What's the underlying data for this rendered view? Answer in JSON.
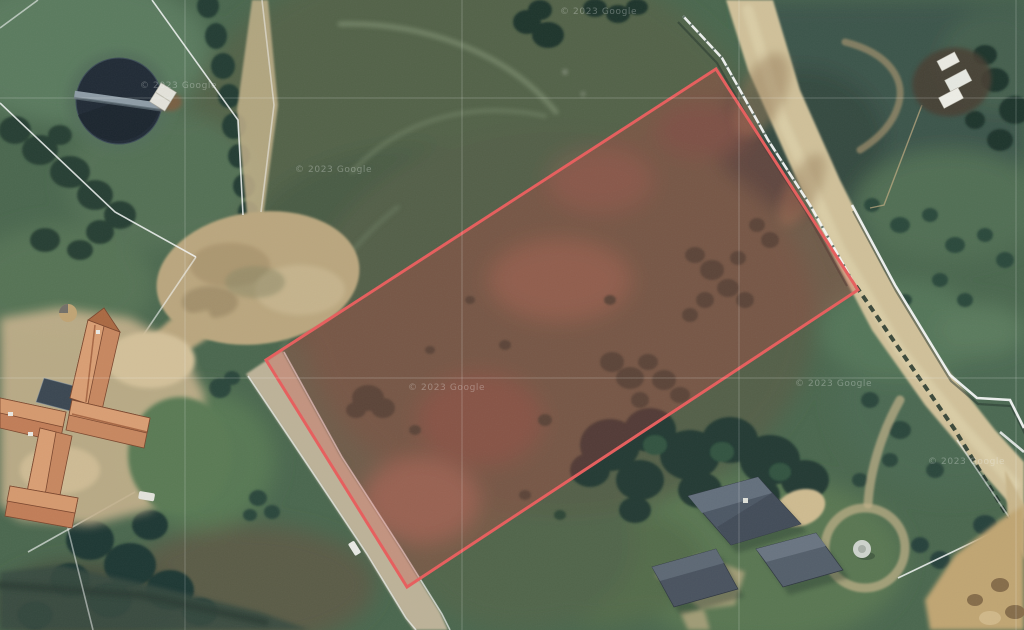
{
  "map": {
    "view_type": "satellite",
    "attribution": {
      "text": "© 2023 Google",
      "positions": [
        [
          560,
          14
        ],
        [
          295,
          172
        ],
        [
          140,
          88
        ],
        [
          408,
          390
        ],
        [
          795,
          386
        ],
        [
          928,
          464
        ]
      ]
    },
    "parcel_overlay": {
      "points": "716,69 858,290 407,587 266,360",
      "stroke_color": "#F15D5D",
      "fill_color": "rgba(221,64,64,0.27)",
      "stroke_width": "3"
    },
    "tile_gridlines": {
      "vertical_x": [
        185,
        462,
        739,
        1016
      ],
      "horizontal_y": [
        98,
        378
      ],
      "color": "rgba(255,255,255,0.22)"
    }
  }
}
